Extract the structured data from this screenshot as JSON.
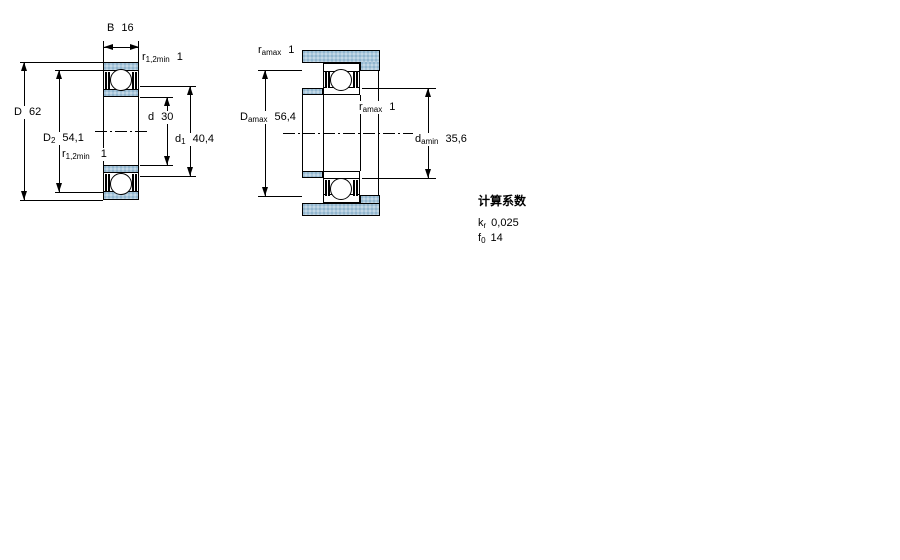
{
  "drawing": {
    "view1": {
      "width_label": {
        "base": "B",
        "value": "16"
      },
      "outer_dia": {
        "base": "D",
        "value": "62"
      },
      "d2": {
        "base": "D",
        "sub": "2",
        "value": "54,1"
      },
      "r12_top": {
        "base": "r",
        "sub": "1,2min",
        "value": "1"
      },
      "r12_bottom": {
        "base": "r",
        "sub": "1,2min",
        "value": "1"
      },
      "bore_dia": {
        "base": "d",
        "value": "30"
      },
      "d1": {
        "base": "d",
        "sub": "1",
        "value": "40,4"
      }
    },
    "view2": {
      "ramax_top": {
        "base": "r",
        "sub": "amax",
        "value": "1"
      },
      "ramax_mid": {
        "base": "r",
        "sub": "amax",
        "value": "1"
      },
      "damax": {
        "base": "D",
        "sub": "amax",
        "value": "56,4"
      },
      "damin": {
        "base": "d",
        "sub": "amin",
        "value": "35,6"
      }
    },
    "calculation_factors": {
      "title": "计算系数",
      "kr": {
        "base": "k",
        "sub": "r",
        "value": "0,025"
      },
      "f0": {
        "base": "f",
        "sub": "0",
        "value": "14"
      }
    },
    "colors": {
      "section_fill": "#aac7db",
      "line": "#000000"
    }
  }
}
